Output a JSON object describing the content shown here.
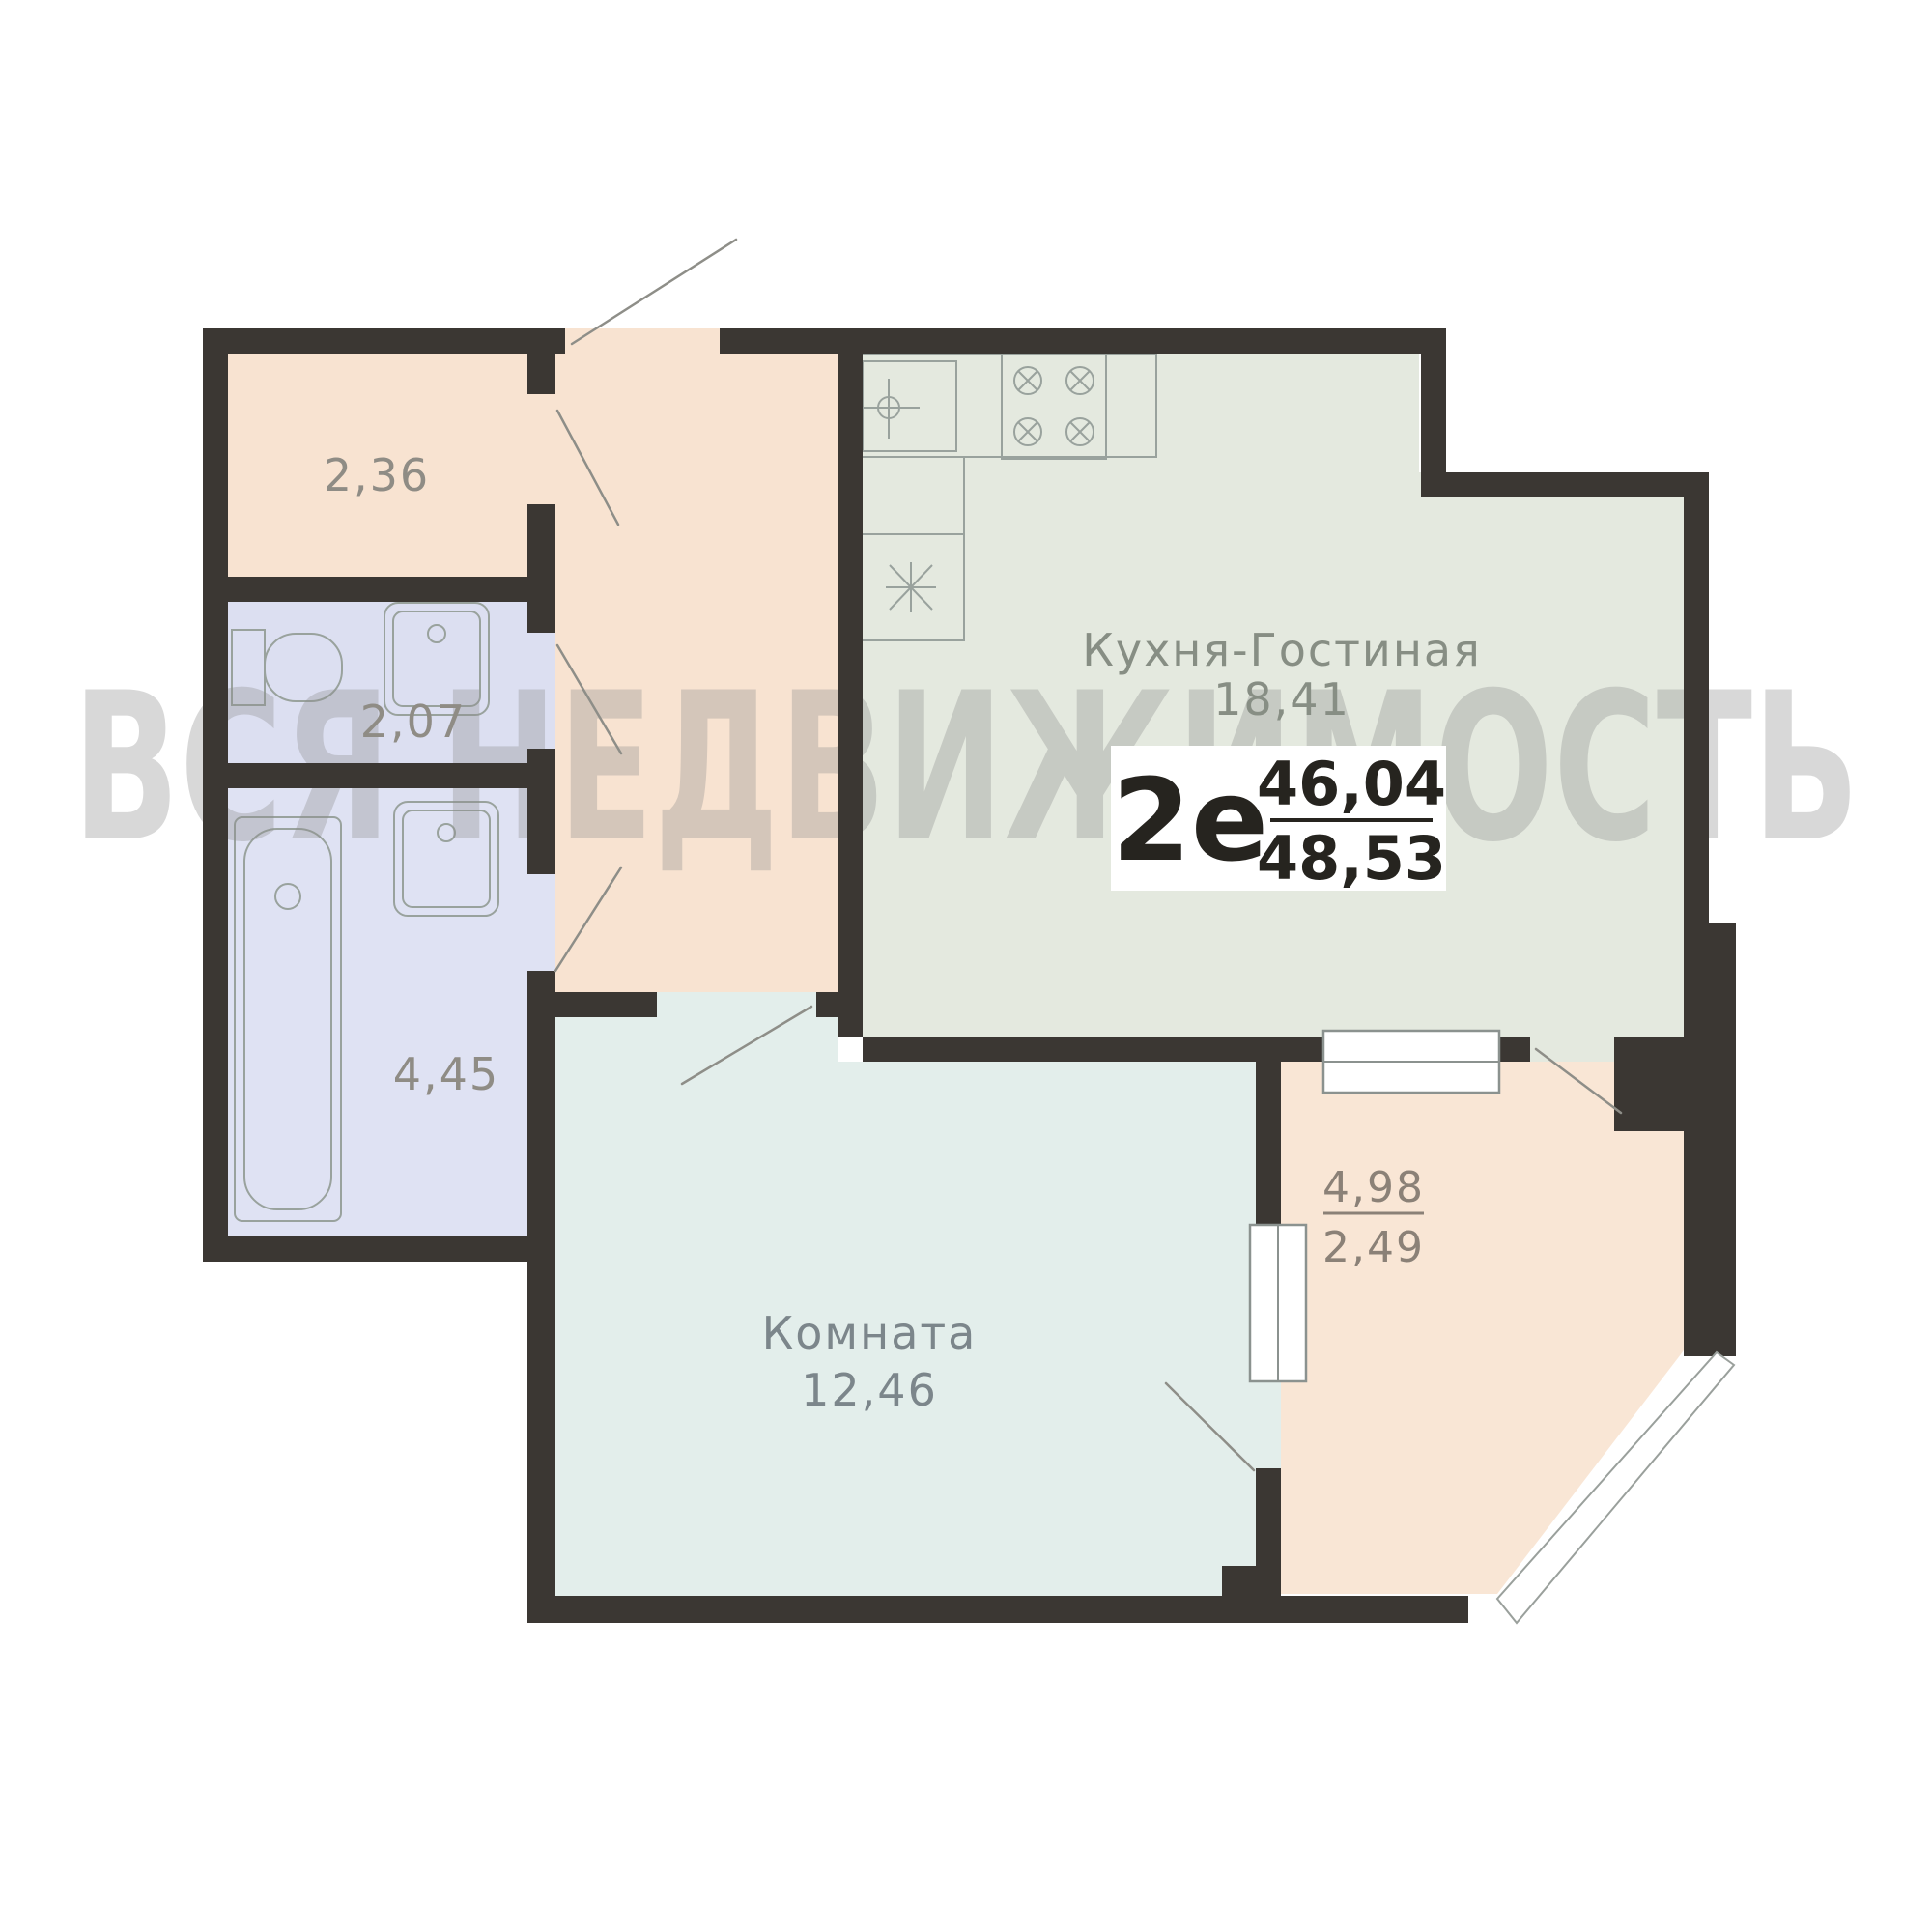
{
  "watermark": "ВСЯ НЕДВИЖИМОСТЬ",
  "badge": {
    "type_label": "2е",
    "area_total": "46,04",
    "area_total_with_balcony": "48,53"
  },
  "rooms": {
    "kitchen_living": {
      "name": "Кухня-Гостиная",
      "area": "18,41"
    },
    "bedroom": {
      "name": "Комната",
      "area": "12,46"
    },
    "hall": {
      "area": "2,36"
    },
    "wc": {
      "area": "2,07"
    },
    "bathroom": {
      "area": "4,45"
    },
    "balcony": {
      "area_full": "4,98",
      "area_reduced": "2,49"
    }
  },
  "colors": {
    "wall": "#3b3733",
    "hall_fill": "#f8e3d1",
    "wc_fill": "#dcdff1",
    "bathroom_fill": "#dfe2f3",
    "kitchen_fill": "#e4e9df",
    "bedroom_fill": "#e3eeeb",
    "balcony_fill": "#f9e6d5",
    "fixture_stroke": "#99a29d",
    "label_text": "#8f8c85",
    "badge_text": "#26241f",
    "watermark_gray": "#8c8c8c"
  }
}
